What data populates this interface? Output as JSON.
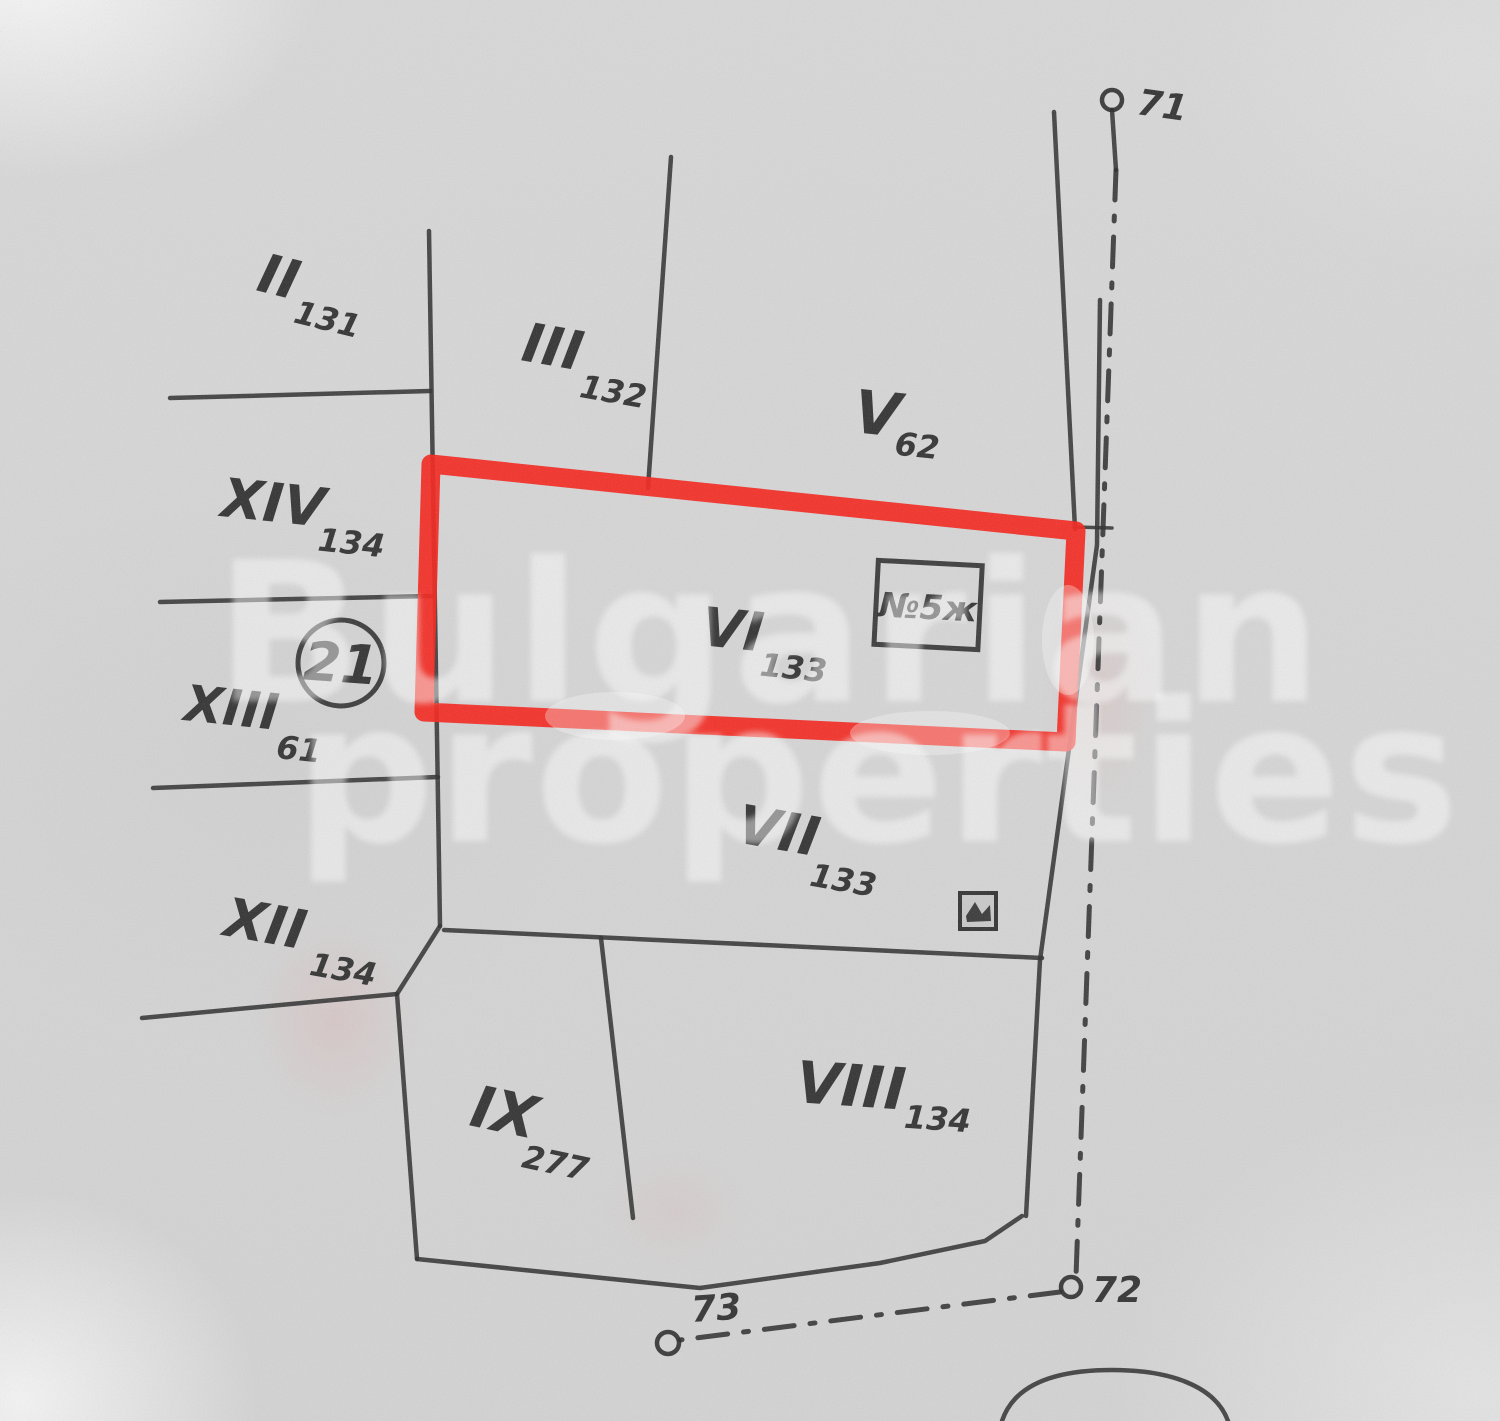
{
  "document": {
    "kind": "scanned cadastral plot sketch",
    "highlighted_parcel": "VI"
  },
  "watermark": {
    "line1": "Bulgarian",
    "line2": "properties"
  },
  "parcels": [
    {
      "numeral": "II",
      "sub": "131"
    },
    {
      "numeral": "III",
      "sub": "132"
    },
    {
      "numeral": "V",
      "sub": "62"
    },
    {
      "numeral": "VI",
      "sub": "133"
    },
    {
      "numeral": "VII",
      "sub": "133"
    },
    {
      "numeral": "VIII",
      "sub": "134"
    },
    {
      "numeral": "IX",
      "sub": "277"
    },
    {
      "numeral": "XII",
      "sub": "134"
    },
    {
      "numeral": "XIII",
      "sub": "61"
    },
    {
      "numeral": "XIV",
      "sub": "134"
    }
  ],
  "annotations": {
    "circled_number": "21",
    "building_box_label": "№5ж"
  },
  "survey_points": [
    {
      "label": "71"
    },
    {
      "label": "72"
    },
    {
      "label": "73"
    }
  ],
  "colors": {
    "paper": "#d7d7d7",
    "ink": "#2e2e2e",
    "highlight": "#f5231a",
    "watermark": "#ffffff"
  }
}
